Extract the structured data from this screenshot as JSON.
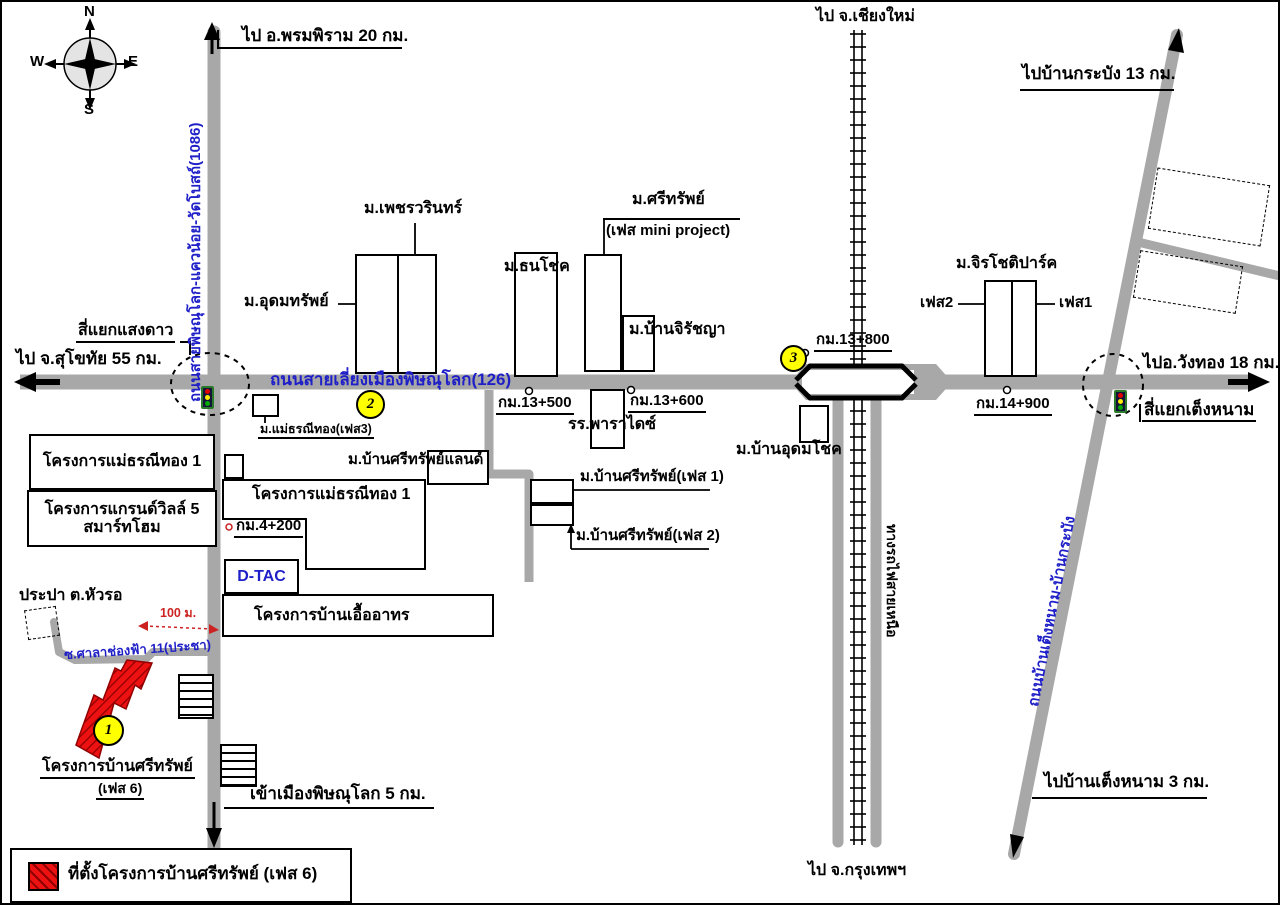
{
  "compass": {
    "n": "N",
    "e": "E",
    "s": "S",
    "w": "W"
  },
  "roads": {
    "route_1086": "ถนนสายพิษณุโลก-แควน้อย-วัดโบสถ์(1086)",
    "bypass_126": "ถนนสายเลี่ยงเมืองพิษณุโลก(126)",
    "tengnam_krabang_road": "ถนนบ้านเต็งหนาม-บ้านกระบัง",
    "northern_railway": "ทางรถไฟสายเหนือ",
    "soi_sala_chongfa": "ซ.ศาลาช่องฟ้า 11(ประชา)"
  },
  "directions": {
    "phromphiram": "ไป อ.พรมพิราม 20 กม.",
    "chiangmai": "ไป จ.เชียงใหม่",
    "ban_krabang": "ไปบ้านกระบัง 13 กม.",
    "sukhothai": "ไป จ.สุโขทัย 55 กม.",
    "wangthong": "ไปอ.วังทอง 18 กม.",
    "ban_tengnam": "ไปบ้านเต็งหนาม 3 กม.",
    "bangkok": "ไป จ.กรุงเทพฯ",
    "city": "เข้าเมืองพิษณุโลก 5 กม."
  },
  "intersections": {
    "saengdao": "สี่แยกแสงดาว",
    "tengnam": "สี่แยกเต็งหนาม"
  },
  "km_markers": {
    "km4_200": "กม.4+200",
    "km13_500": "กม.13+500",
    "km13_600": "กม.13+600",
    "km13_800": "กม.13+800",
    "km14_900": "กม.14+900"
  },
  "places": {
    "phetwarin": "ม.เพชรวรินทร์",
    "udomsap": "ม.อุดมทรัพย์",
    "thanachok": "ม.ธนโชค",
    "srisap": "ม.ศรีทรัพย์",
    "srisap_mini": "(เฟส mini project)",
    "jiratchaya": "ม.บ้านจิรัชญา",
    "jirachotipark": "ม.จิรโชติปาร์ค",
    "jirachoti_phase1": "เฟส1",
    "jirachoti_phase2": "เฟส2",
    "paradise_school": "รร.พาราไดซ์",
    "maethorani_phase3": "ม.แม่ธรณีทอง(เฟส3)",
    "srisap_land": "ม.บ้านศรีทรัพย์แลนด์",
    "srisap_phase1": "ม.บ้านศรีทรัพย์(เฟส 1)",
    "srisap_phase2": "ม.บ้านศรีทรัพย์(เฟส 2)",
    "ban_udomchok": "ม.บ้านอุดมโชค",
    "maethorani1_west": "โครงการแม่ธรณีทอง 1",
    "grandville_line1": "โครงการแกรนด์วิลล์ 5",
    "grandville_line2": "สมาร์ทโฮม",
    "maethorani1_east": "โครงการแม่ธรณีทอง 1",
    "uea_athon": "โครงการบ้านเอื้ออาทร",
    "prapa_huaro": "ประปา ต.หัวรอ",
    "dtac": "D-TAC"
  },
  "site_label": {
    "line1": "โครงการบ้านศรีทรัพย์",
    "line2": "(เฟส 6)"
  },
  "badges": {
    "site": "1",
    "bypass": "2",
    "bridge": "3"
  },
  "annotations": {
    "distance_100m": "100 ม."
  },
  "legend": {
    "text": "ที่ตั้งโครงการบ้านศรีทรัพย์ (เฟส 6)"
  },
  "colors": {
    "road_gray": "#a8a8a8",
    "blue_text": "#1f1fc8",
    "site_red": "#ee1111",
    "badge_yellow": "#ffff00"
  }
}
